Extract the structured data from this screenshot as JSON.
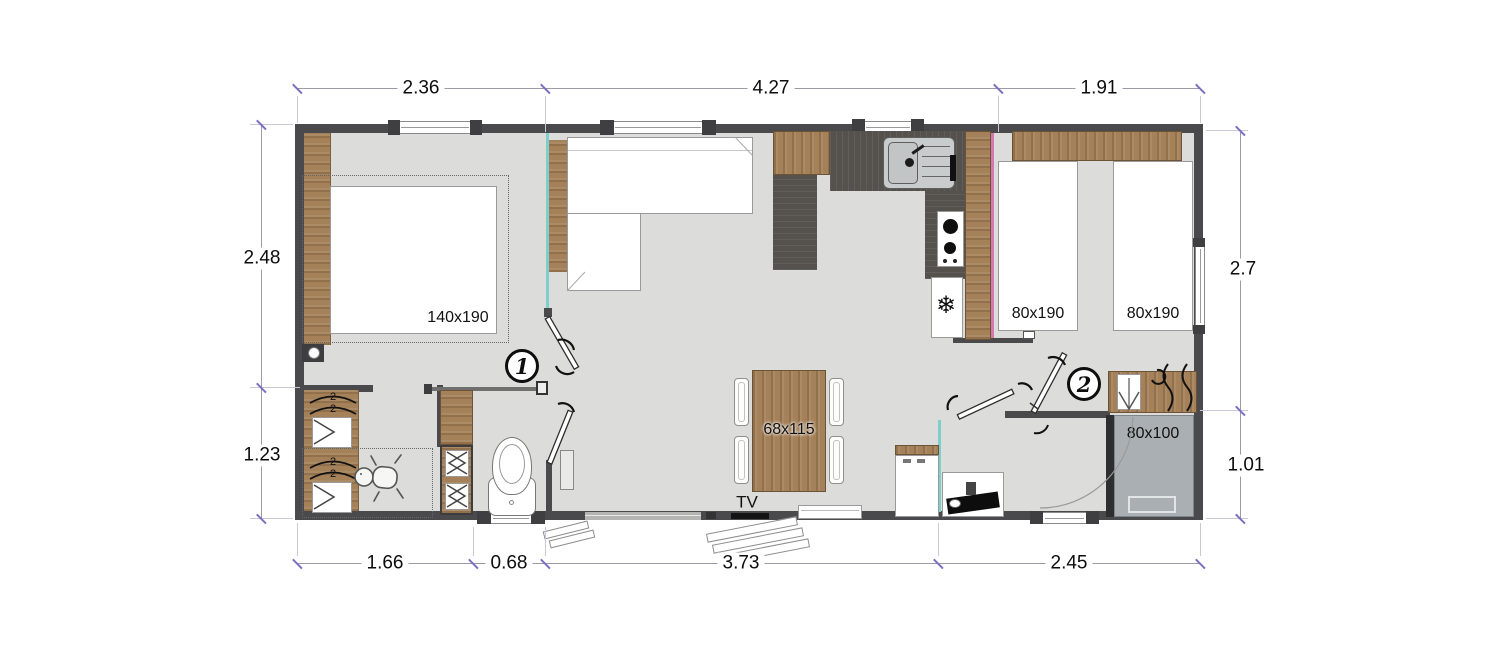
{
  "plan_type": "mobile-home-floor-plan",
  "colors": {
    "wall": "#4a4a4c",
    "wood": "#a5815a",
    "kitchen_counter": "#55514d",
    "floor": "#dcdcda",
    "shower_tray": "#a9afb3",
    "partition_glass": "#7ecfca",
    "partition_pink": "#d478ad",
    "dimension_tick": "#7d6fc0"
  },
  "dimensions": {
    "top": [
      {
        "label": "2.36"
      },
      {
        "label": "4.27"
      },
      {
        "label": "1.91"
      }
    ],
    "bottom": [
      {
        "label": "1.66"
      },
      {
        "label": "0.68"
      },
      {
        "label": "3.73"
      },
      {
        "label": "2.45"
      }
    ],
    "left": [
      {
        "label": "2.48"
      },
      {
        "label": "1.23"
      }
    ],
    "right": [
      {
        "label": "2.7"
      },
      {
        "label": "1.01"
      }
    ]
  },
  "labels": {
    "master_bed": "140x190",
    "twin_bed_left": "80x190",
    "twin_bed_right": "80x190",
    "dining_table": "68x115",
    "shower": "80x100",
    "tv": "TV",
    "marker_1": "1",
    "marker_2": "2",
    "bunk_sleeps": "2"
  },
  "icons": {
    "fridge": "snowflake-icon",
    "hob": "burner-icons",
    "nursery": "baby-icon",
    "vanity": "washbasin-icon",
    "window_shade": "curtain-icon"
  }
}
